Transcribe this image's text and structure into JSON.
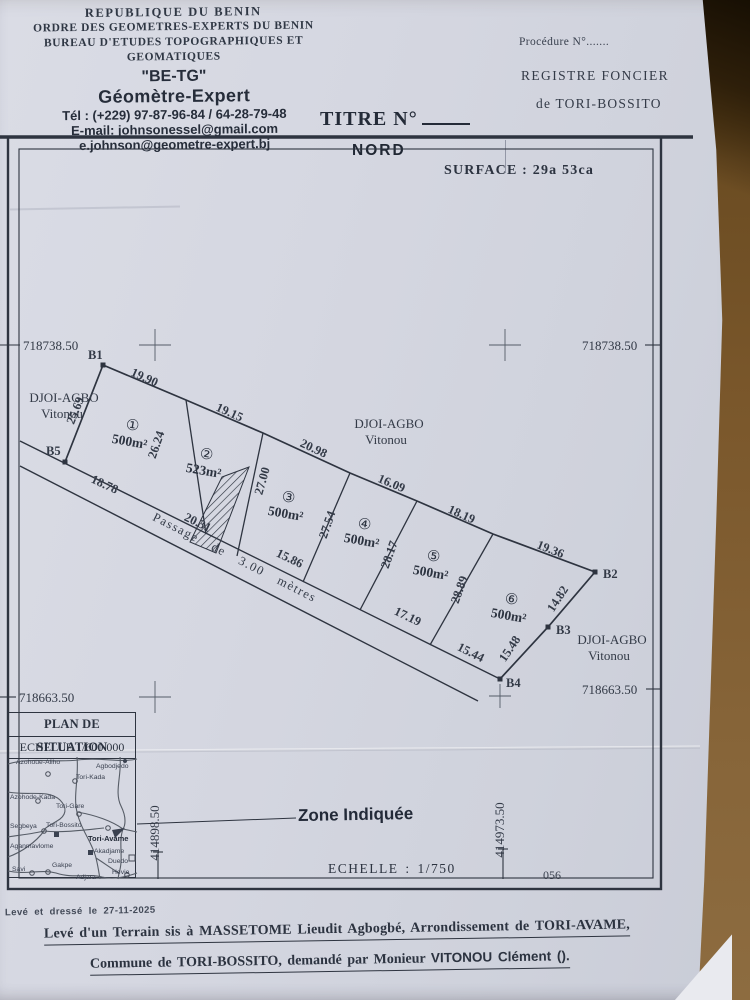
{
  "header": {
    "line1": "REPUBLIQUE DU BENIN",
    "line2": "ORDRE DES GEOMETRES-EXPERTS DU BENIN",
    "line3": "BUREAU D'ETUDES TOPOGRAPHIQUES ET GEOMATIQUES",
    "brand": "\"BE-TG\"",
    "profession": "Géomètre-Expert",
    "tel": "Tél : (+229) 97-87-96-84 / 64-28-79-48",
    "email1": "E-mail: johnsonessel@gmail.com",
    "email2": "e.johnson@geometre-expert.bj"
  },
  "registry": {
    "procedure": "Procédure N°.......",
    "registre_line1": "REGISTRE FONCIER",
    "registre_line2": "de TORI-BOSSITO",
    "titre_label": "TITRE N°"
  },
  "plan": {
    "north_label": "NORD",
    "surface_label": "SURFACE : 29a 53ca",
    "coord_north": "718738.50",
    "coord_south": "718663.50",
    "coord_west": "414898.50",
    "coord_east": "414973.50",
    "scale_label": "ECHELLE : 1/750",
    "sheet_number": "056",
    "region_name": "DJOI-AGBO",
    "region_owner": "Vitonou",
    "passage_label": "Passage de 3.00 mètres",
    "points": [
      "B1",
      "B2",
      "B3",
      "B4",
      "B5"
    ],
    "parcels": [
      {
        "num": "①",
        "area": "500m²"
      },
      {
        "num": "②",
        "area": "523m²"
      },
      {
        "num": "③",
        "area": "500m²"
      },
      {
        "num": "④",
        "area": "500m²"
      },
      {
        "num": "⑤",
        "area": "500m²"
      },
      {
        "num": "⑥",
        "area": "500m²"
      }
    ],
    "measures": {
      "top": [
        "19.90",
        "19.15",
        "20.98",
        "16.09",
        "18.19",
        "19.36"
      ],
      "sides": [
        "25.69",
        "26.24",
        "27.00",
        "27.54",
        "28.17",
        "28.89",
        "14.82",
        "15.48"
      ],
      "bottom": [
        "18.78",
        "20.31",
        "15.86",
        "17.19",
        "15.44"
      ]
    }
  },
  "situation": {
    "title": "PLAN DE SITUATION",
    "scale": "ECHELLE 1/600 000",
    "zone_label": "Zone Indiquée",
    "places": [
      "Azohoue-Aliho",
      "Agbodjedo",
      "Tori-Kada",
      "Azohode-Kada",
      "Tori-Gare",
      "Segbeya",
      "Tori-Bossito",
      "Tori-Avame",
      "Aganmavlome",
      "Akadjame",
      "Duedo",
      "Savi",
      "Gakpe",
      "Adjara",
      "Hevie"
    ]
  },
  "footer": {
    "drafted": "Levé et dressé  le 27-11-2025",
    "line1": "Levé d'un Terrain sis à MASSETOME Lieudit Agbogbé, Arrondissement de TORI-AVAME,",
    "line2_prefix": "Commune de TORI-BOSSITO, demandé par Monieur ",
    "line2_client": "VITONOU Clément ()."
  },
  "colors": {
    "ink": "#2e3440",
    "paper": "#d6d8e1",
    "cardboard": "#7a572b"
  }
}
